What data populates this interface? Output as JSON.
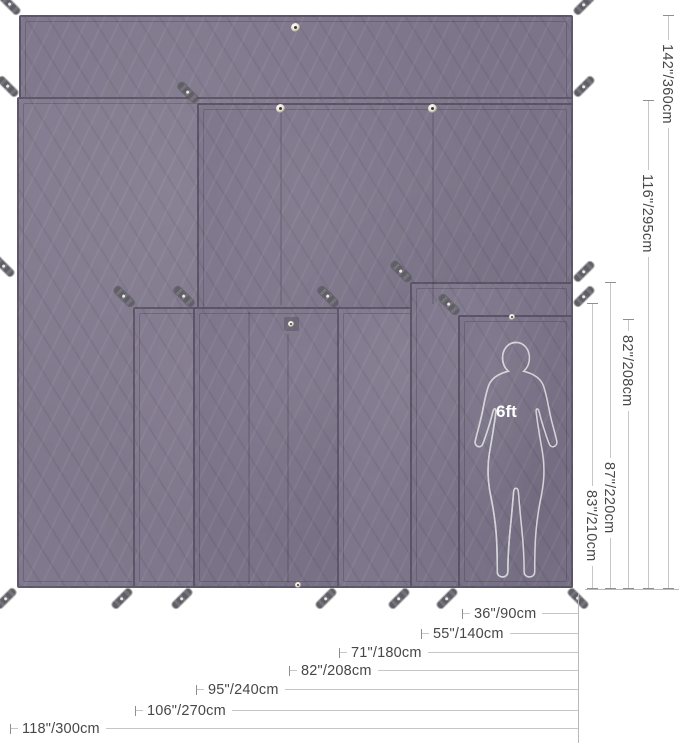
{
  "diagram": {
    "type": "product-size-diagram",
    "subject": "overlapping camping tarps / tent footprints with stake loops and grommets",
    "person_label": "6ft",
    "colors": {
      "tarp_fabric": "#7c7489",
      "tarp_hem": "#3e3848",
      "stake_loop": "#67656c",
      "dim_line": "#c6c6c6",
      "dim_text": "#474747",
      "silhouette_solid": "#a7a7ab",
      "silhouette_outline": "#d4d4d8",
      "background": "#ffffff"
    }
  },
  "dims": {
    "heights": [
      {
        "label": "142\"/360cm"
      },
      {
        "label": "116\"/295cm"
      },
      {
        "label": "82\"/208cm"
      },
      {
        "label": "87\"/220cm"
      },
      {
        "label": "83\"/210cm"
      }
    ],
    "widths": [
      {
        "label": "36\"/90cm"
      },
      {
        "label": "55\"/140cm"
      },
      {
        "label": "71\"/180cm"
      },
      {
        "label": "82\"/208cm"
      },
      {
        "label": "95\"/240cm"
      },
      {
        "label": "106\"/270cm"
      },
      {
        "label": "118\"/300cm"
      }
    ]
  }
}
